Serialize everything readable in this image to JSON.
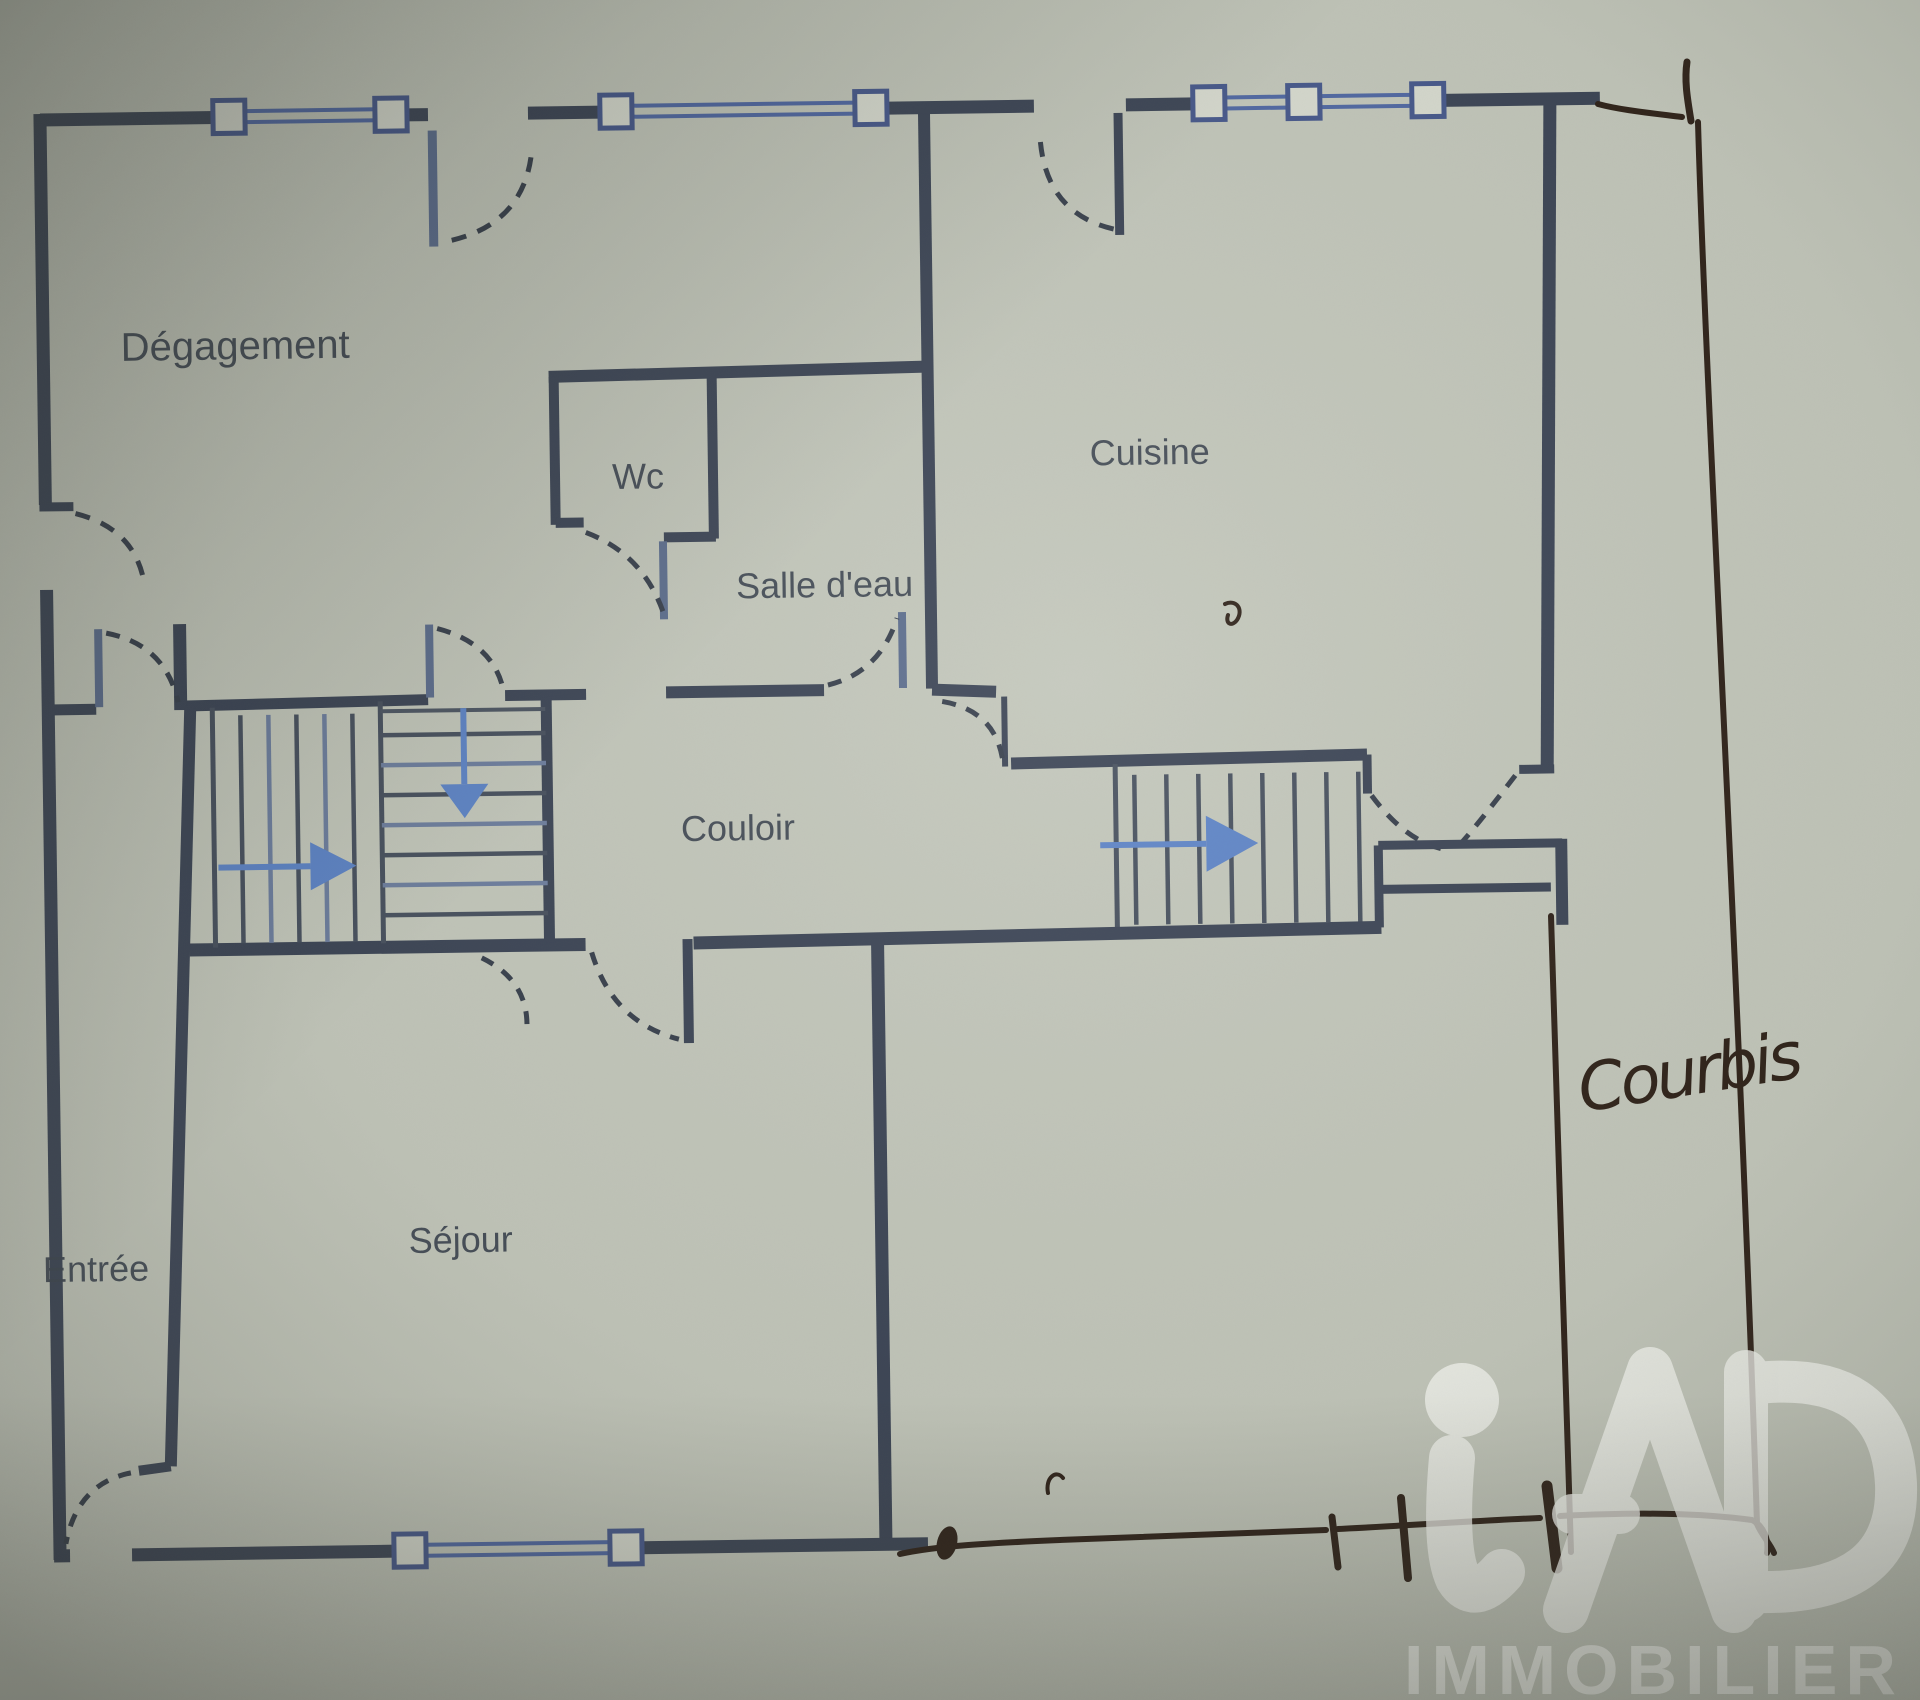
{
  "document": {
    "kind": "photographed floor plan",
    "paper_color": "#c2c6ba"
  },
  "floor_plan": {
    "rooms": [
      {
        "id": "degagement",
        "label": "Dégagement"
      },
      {
        "id": "wc",
        "label": "Wc"
      },
      {
        "id": "salle_deau",
        "label": "Salle d'eau"
      },
      {
        "id": "cuisine",
        "label": "Cuisine"
      },
      {
        "id": "couloir",
        "label": "Couloir"
      },
      {
        "id": "entree",
        "label": "Entrée"
      },
      {
        "id": "sejour",
        "label": "Séjour"
      }
    ],
    "symbols": {
      "window_icon": "double blue line with square end posts",
      "door_icon": "dashed quarter-circle swing arc",
      "stair_arrow_icon": "blue direction arrow"
    },
    "colors": {
      "wall": "#394253",
      "window_blue": "#4e66a2",
      "window_post_fill": "#d7dacf",
      "arrow_blue": "#5b82c6",
      "label_text": "#3a424e"
    }
  },
  "annotations": {
    "handwritten_label": "Courbis",
    "pen_color": "#2c1f16",
    "description": "hand-drawn boundary lines with tick marks along right and bottom"
  },
  "watermark": {
    "brand": "iAD",
    "tagline": "IMMOBILIER",
    "color": "#f5f6f1"
  }
}
